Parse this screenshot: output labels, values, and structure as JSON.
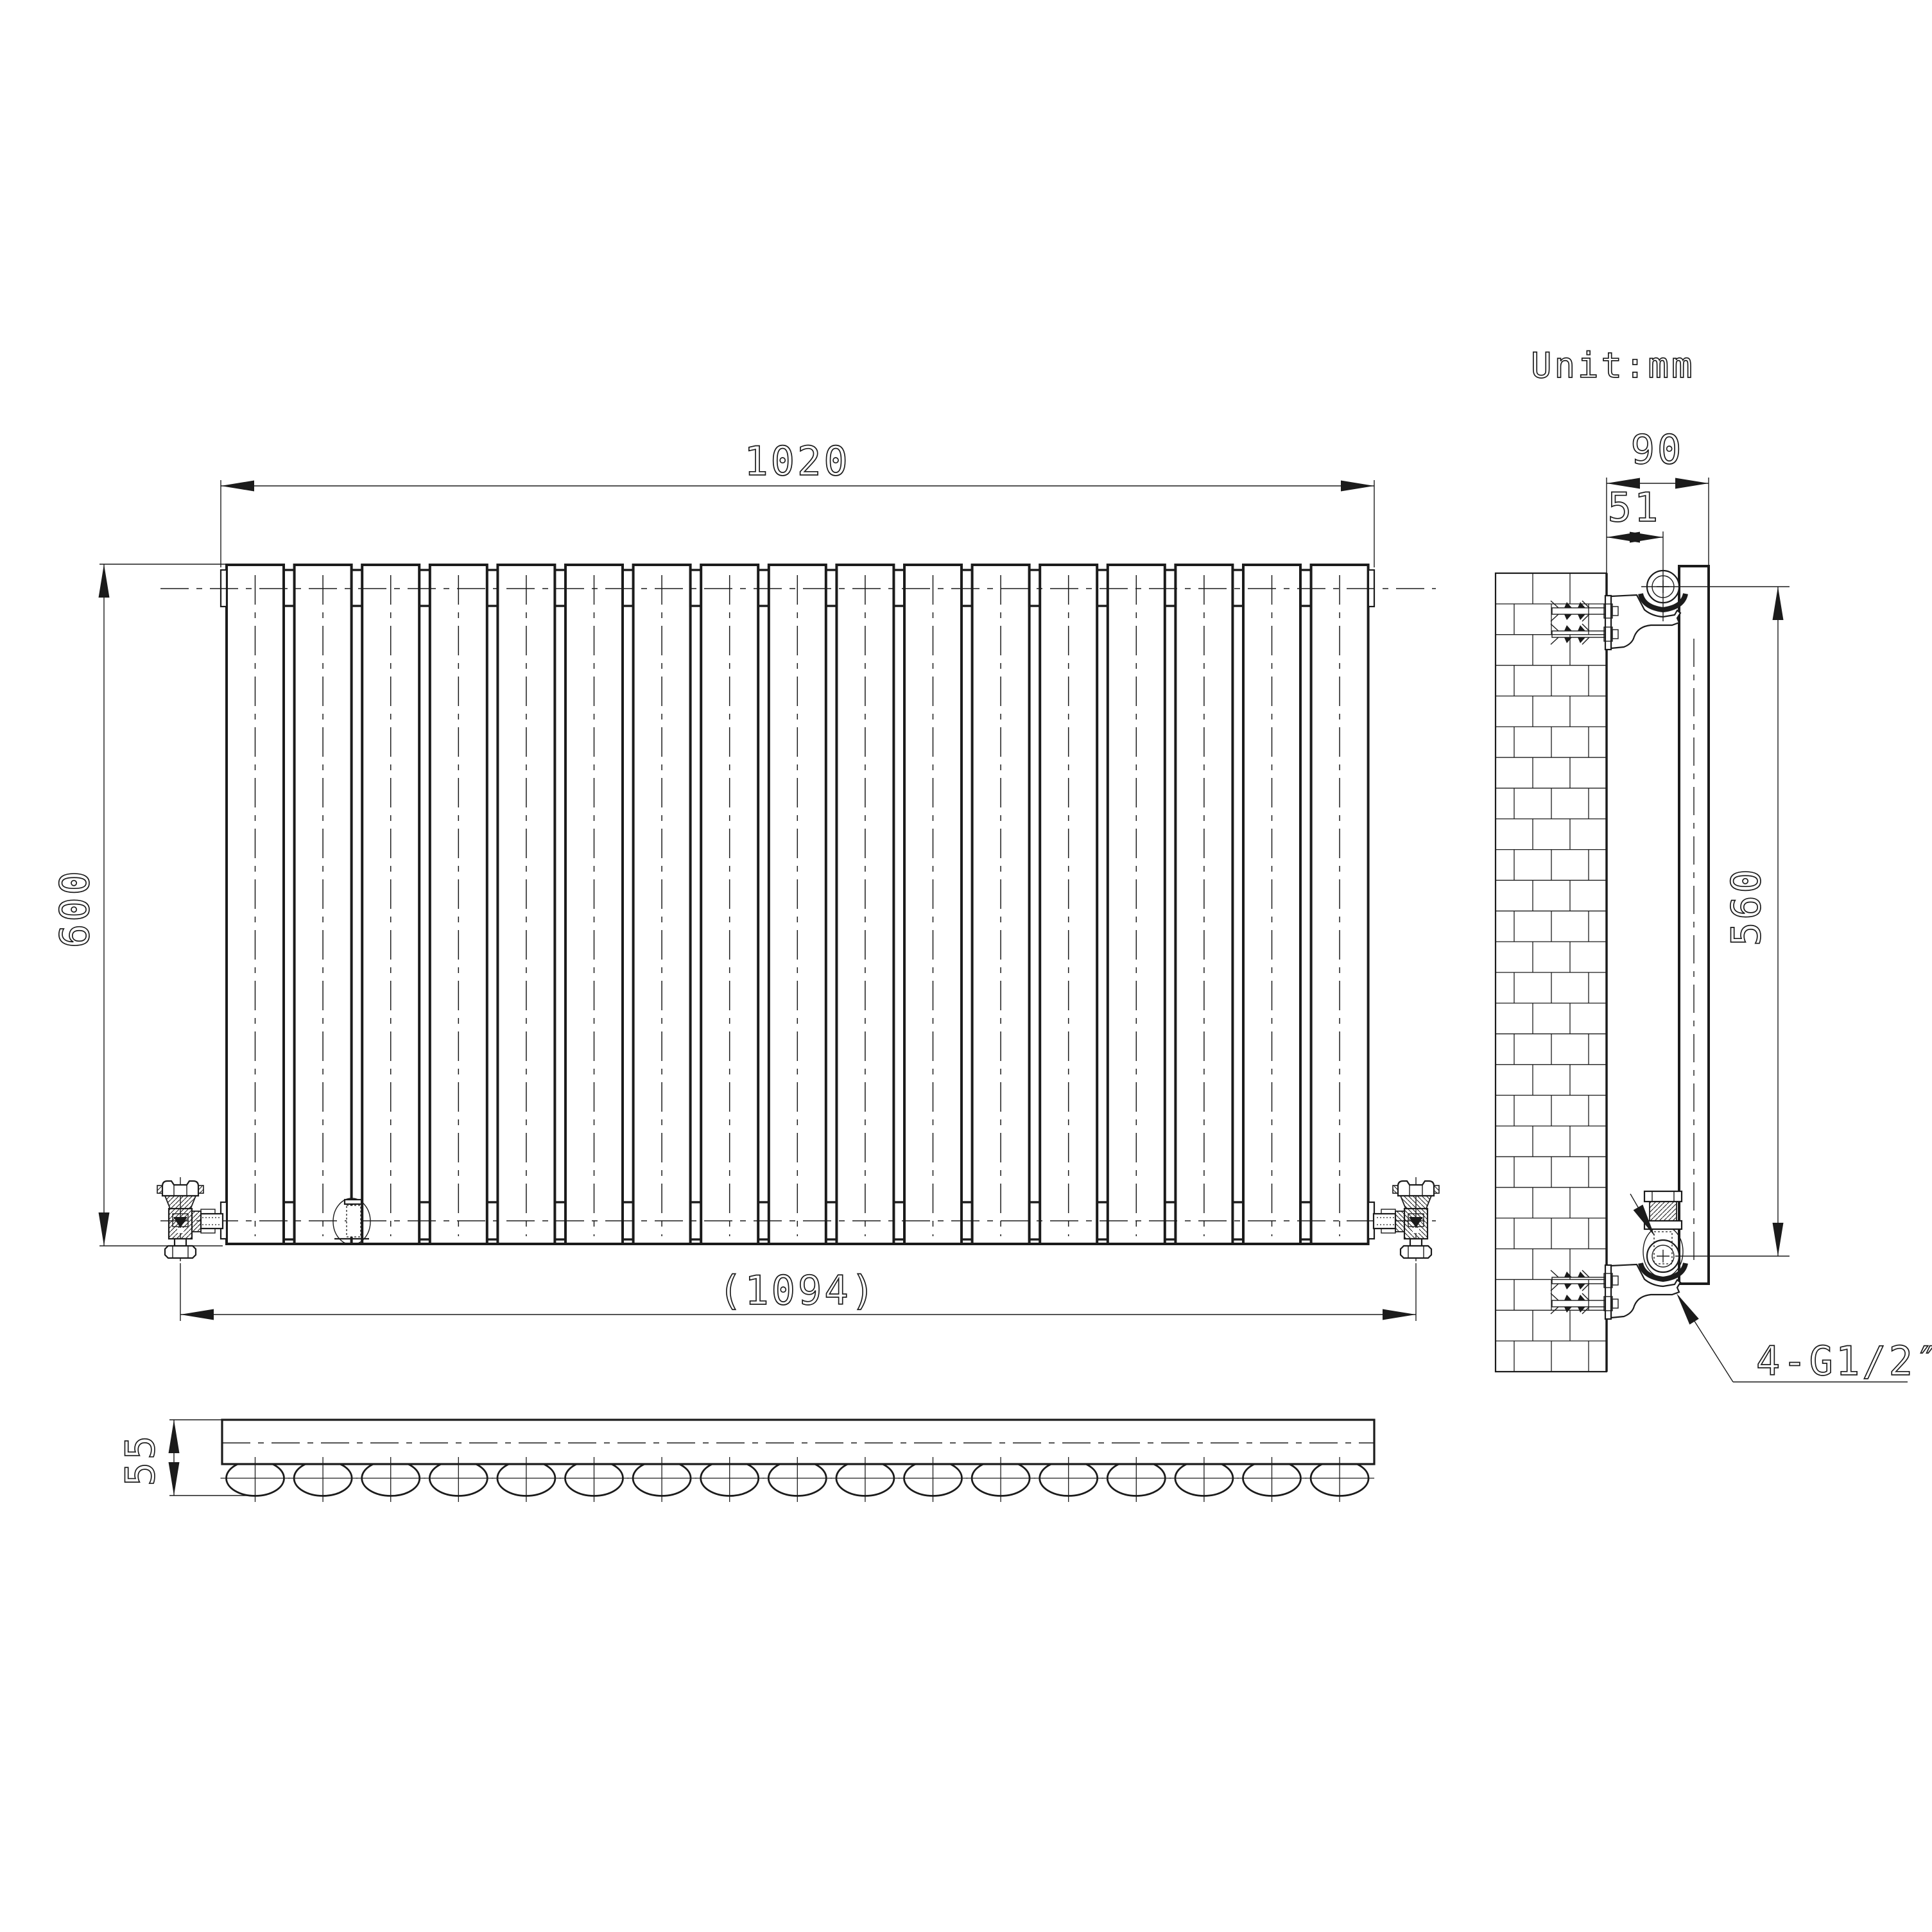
{
  "drawing": {
    "unit_note": "Unit:mm",
    "line_color": "#1b1b1b",
    "background_color": "#ffffff",
    "views": {
      "front": {
        "panel_count": 17,
        "dimensions": {
          "overall_width_mm": "1020",
          "overall_height_mm": "600",
          "valve_to_valve_width_mm": "(1094)"
        }
      },
      "side": {
        "brick_rows": 26,
        "dimensions": {
          "bracket_depth_mm": "90",
          "pipe_center_offset_mm": "51",
          "bracket_span_mm": "560"
        },
        "connection_label": "4-G1/2″"
      },
      "top": {
        "tube_count": 17,
        "dimensions": {
          "depth_mm": "55"
        }
      }
    }
  }
}
